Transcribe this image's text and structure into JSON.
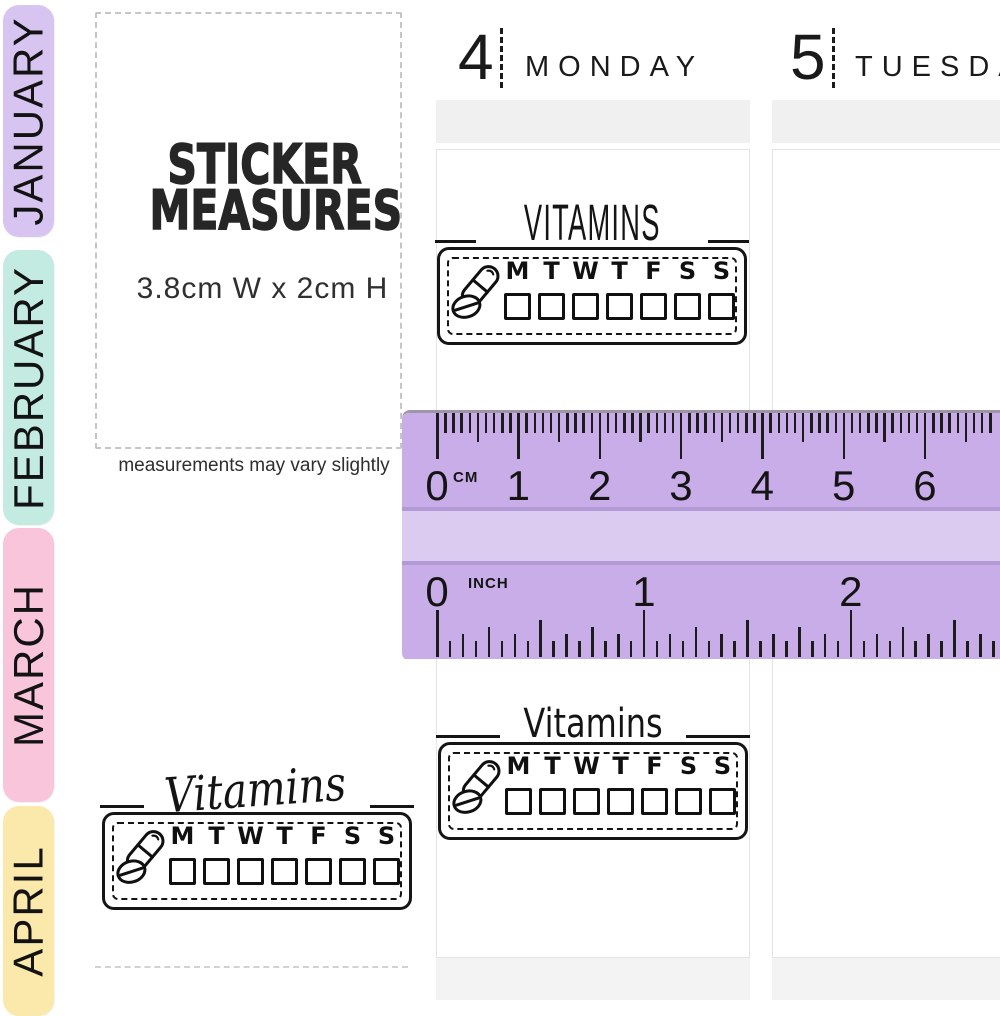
{
  "tabs": [
    {
      "label": "JANUARY",
      "color": "#d8c4f1"
    },
    {
      "label": "FEBRUARY",
      "color": "#c3ebe1"
    },
    {
      "label": "MARCH",
      "color": "#f9c5da"
    },
    {
      "label": "APRIL",
      "color": "#fbe8ab"
    }
  ],
  "measures": {
    "title_line1": "STICKER",
    "title_line2": "MEASURES",
    "size": "3.8cm W x 2cm H",
    "note": "measurements may vary slightly"
  },
  "columns": [
    {
      "date": "4",
      "day": "MONDAY"
    },
    {
      "date": "5",
      "day": "TUESDAY"
    }
  ],
  "sticker_days": [
    "M",
    "T",
    "W",
    "T",
    "F",
    "S",
    "S"
  ],
  "stickers": [
    {
      "title": "VITAMINS",
      "style": "caps",
      "icon": "pill-capsule-icon"
    },
    {
      "title": "Vitamins",
      "style": "print",
      "icon": "pill-capsule-icon"
    },
    {
      "title": "Vitamins",
      "style": "script",
      "icon": "pill-capsule-icon"
    }
  ],
  "ruler": {
    "cm_unit_label": "CM",
    "inch_unit_label": "INCH",
    "cm_numbers": [
      "0",
      "1",
      "2",
      "3",
      "4",
      "5",
      "6"
    ],
    "inch_numbers": [
      "0",
      "1",
      "2"
    ],
    "body_color": "#c9ade8",
    "mid_color": "#dccbf1",
    "divider_color": "#b29ad6"
  }
}
